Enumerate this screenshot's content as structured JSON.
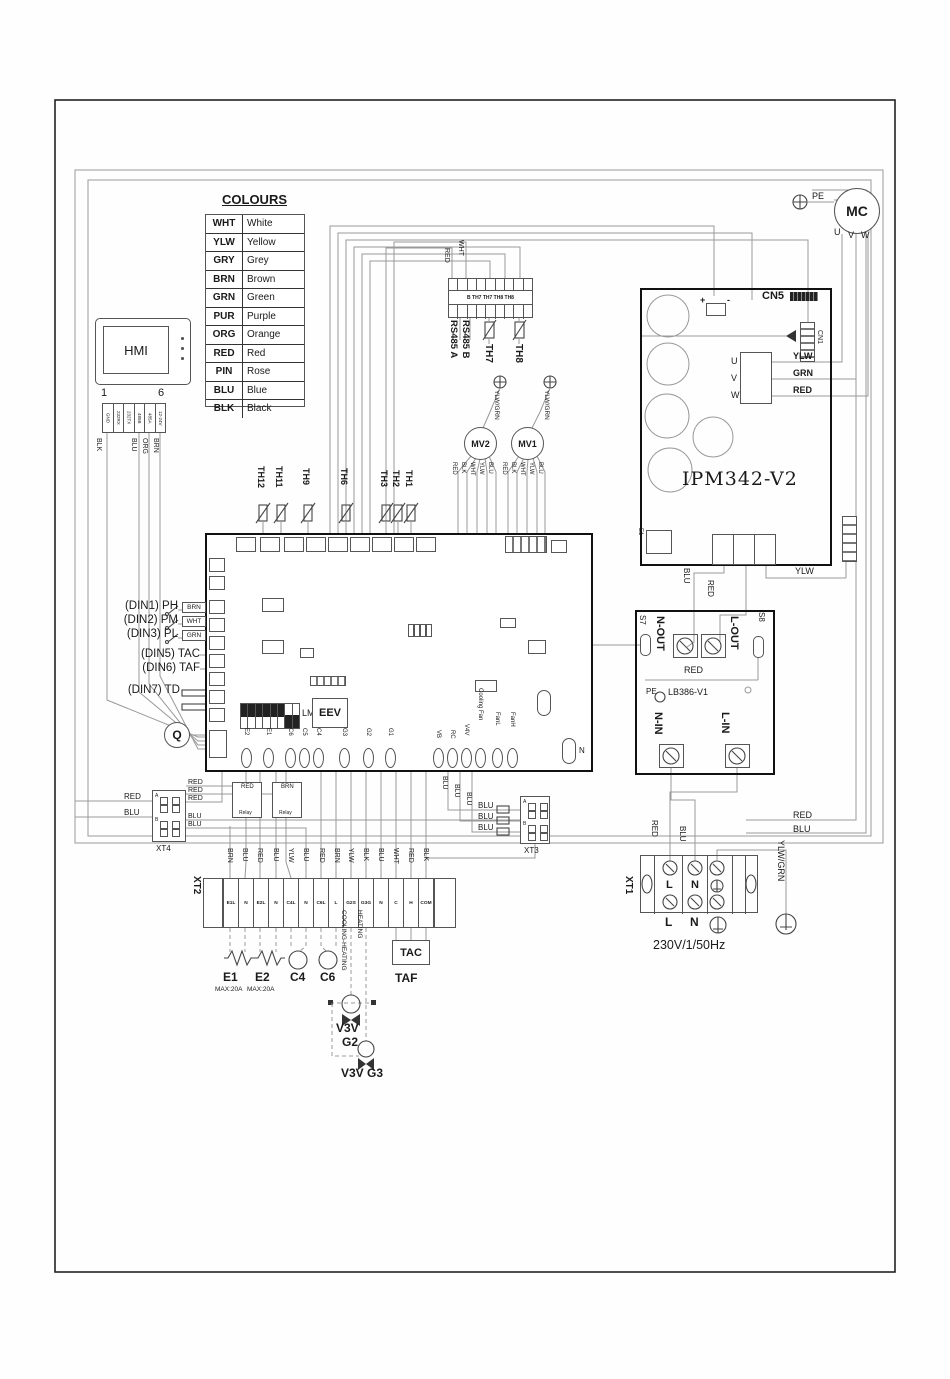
{
  "colours": {
    "title": "COLOURS",
    "rows": [
      {
        "code": "WHT",
        "name": "White"
      },
      {
        "code": "YLW",
        "name": "Yellow"
      },
      {
        "code": "GRY",
        "name": "Grey"
      },
      {
        "code": "BRN",
        "name": "Brown"
      },
      {
        "code": "GRN",
        "name": "Green"
      },
      {
        "code": "PUR",
        "name": "Purple"
      },
      {
        "code": "ORG",
        "name": "Orange"
      },
      {
        "code": "RED",
        "name": "Red"
      },
      {
        "code": "PIN",
        "name": "Rose"
      },
      {
        "code": "BLU",
        "name": "Blue"
      },
      {
        "code": "BLK",
        "name": "Black"
      }
    ]
  },
  "hmi": {
    "label": "HMI",
    "pin_first": "1",
    "pin_last": "6",
    "pins": [
      "GND",
      "232RX",
      "232TX",
      "485B",
      "485A",
      "12-24V"
    ],
    "wire_colors": [
      "BLK",
      "BLU",
      "ORG",
      "BRN"
    ]
  },
  "comm": {
    "row_label": "B TH7 TH7 TH8 TH8",
    "red": "RED",
    "wht": "WHT",
    "rs485a": "RS485 A",
    "rs485b": "RS485 B",
    "th7": "TH7",
    "th8": "TH8"
  },
  "valves": {
    "mv2": "MV2",
    "mv1": "MV1",
    "mv2_wires": [
      "RED",
      "BLK",
      "WHT",
      "YLW",
      "BLU"
    ],
    "mv1_wires": [
      "RED",
      "BLK",
      "WHT",
      "YLW",
      "BLU"
    ],
    "pe_wire_left": "YLW/GRN",
    "pe_wire_right": "YLW/GRN"
  },
  "sensors": [
    "TH12",
    "TH11",
    "TH9",
    "TH6",
    "TH3",
    "TH2",
    "TH1"
  ],
  "compressor": {
    "label": "MC",
    "pe": "PE",
    "u": "U",
    "v": "V",
    "w": "W"
  },
  "ipm": {
    "title": "IPM342-V2",
    "cn5": "CN5",
    "cn1": "CN1",
    "plus": "+",
    "minus": "-",
    "u": "U",
    "v": "V",
    "w": "W",
    "ylw": "YLW",
    "grn": "GRN",
    "red": "RED",
    "e1": "E1",
    "out_blu": "BLU",
    "out_red": "RED",
    "out_ylw": "YLW"
  },
  "lb386": {
    "title": "LB386-V1",
    "pe": "PE",
    "s7": "S7",
    "s8": "S8",
    "n_out": "N-OUT",
    "l_out": "L-OUT",
    "n_in": "N-IN",
    "l_in": "L-IN",
    "red": "RED"
  },
  "board": {
    "din1": "(DIN1) PH",
    "din1_wire": "BRN",
    "din2": "(DIN2) PM",
    "din2_wire": "WHT",
    "din3": "(DIN3) PL",
    "din3_wire": "GRN",
    "din5": "(DIN5) TAC",
    "din6": "(DIN6) TAF",
    "din7": "(DIN7) TD",
    "q": "Q",
    "lms": "LMS",
    "eev": "EEV",
    "outputs_left": [
      "E2",
      "E1",
      "C6",
      "C5",
      "C4",
      "G3",
      "G2",
      "G1"
    ],
    "outputs_right": [
      "VB",
      "RC",
      "V4V",
      "Cooling Fan",
      "FanL",
      "FanH"
    ],
    "n": "N"
  },
  "xt4": {
    "label": "XT4",
    "row_a": "A",
    "row_b": "B",
    "in_red": "RED",
    "in_blu": "BLU",
    "out": [
      "RED",
      "RED",
      "RED",
      "BLU",
      "BLU"
    ]
  },
  "relays": {
    "r1": "RED",
    "r2": "BRN",
    "name": "Relay"
  },
  "xt3": {
    "label": "XT3",
    "row_a": "A",
    "row_b": "B",
    "wires_v": [
      "BLU",
      "BLU",
      "BLU"
    ],
    "wires_h": [
      "BLU",
      "BLU",
      "BLU"
    ]
  },
  "xt2": {
    "label": "XT2",
    "terminals": [
      "E1L",
      "N",
      "E2L",
      "N",
      "C4L",
      "N",
      "C6L",
      "L",
      "G2S",
      "G3G",
      "N",
      "C",
      "H",
      "COM"
    ],
    "wire_colors": [
      "BRN",
      "BLU",
      "RED",
      "BLU",
      "YLW",
      "BLU",
      "RED",
      "BRN",
      "YLW",
      "BLK",
      "BLU",
      "WHT",
      "RED",
      "BLK"
    ]
  },
  "loads": {
    "e1": "E1",
    "e1_max": "MAX:20A",
    "e2": "E2",
    "e2_max": "MAX:20A",
    "c4": "C4",
    "c6": "C6",
    "cooling_heating": "COOLING-HEATING",
    "heating": "HEATING",
    "v3v": "V3V",
    "g2": "G2",
    "v3v_g3": "V3V G3",
    "tac": "TAC",
    "taf": "TAF"
  },
  "xt1": {
    "label": "XT1",
    "l_top": "L",
    "n_top": "N",
    "l_bot": "L",
    "n_bot": "N",
    "supply": "230V/1/50Hz",
    "red": "RED",
    "blu": "BLU",
    "ylwgrn": "YLW/GRN"
  },
  "edge": {
    "red": "RED",
    "blu": "BLU"
  }
}
